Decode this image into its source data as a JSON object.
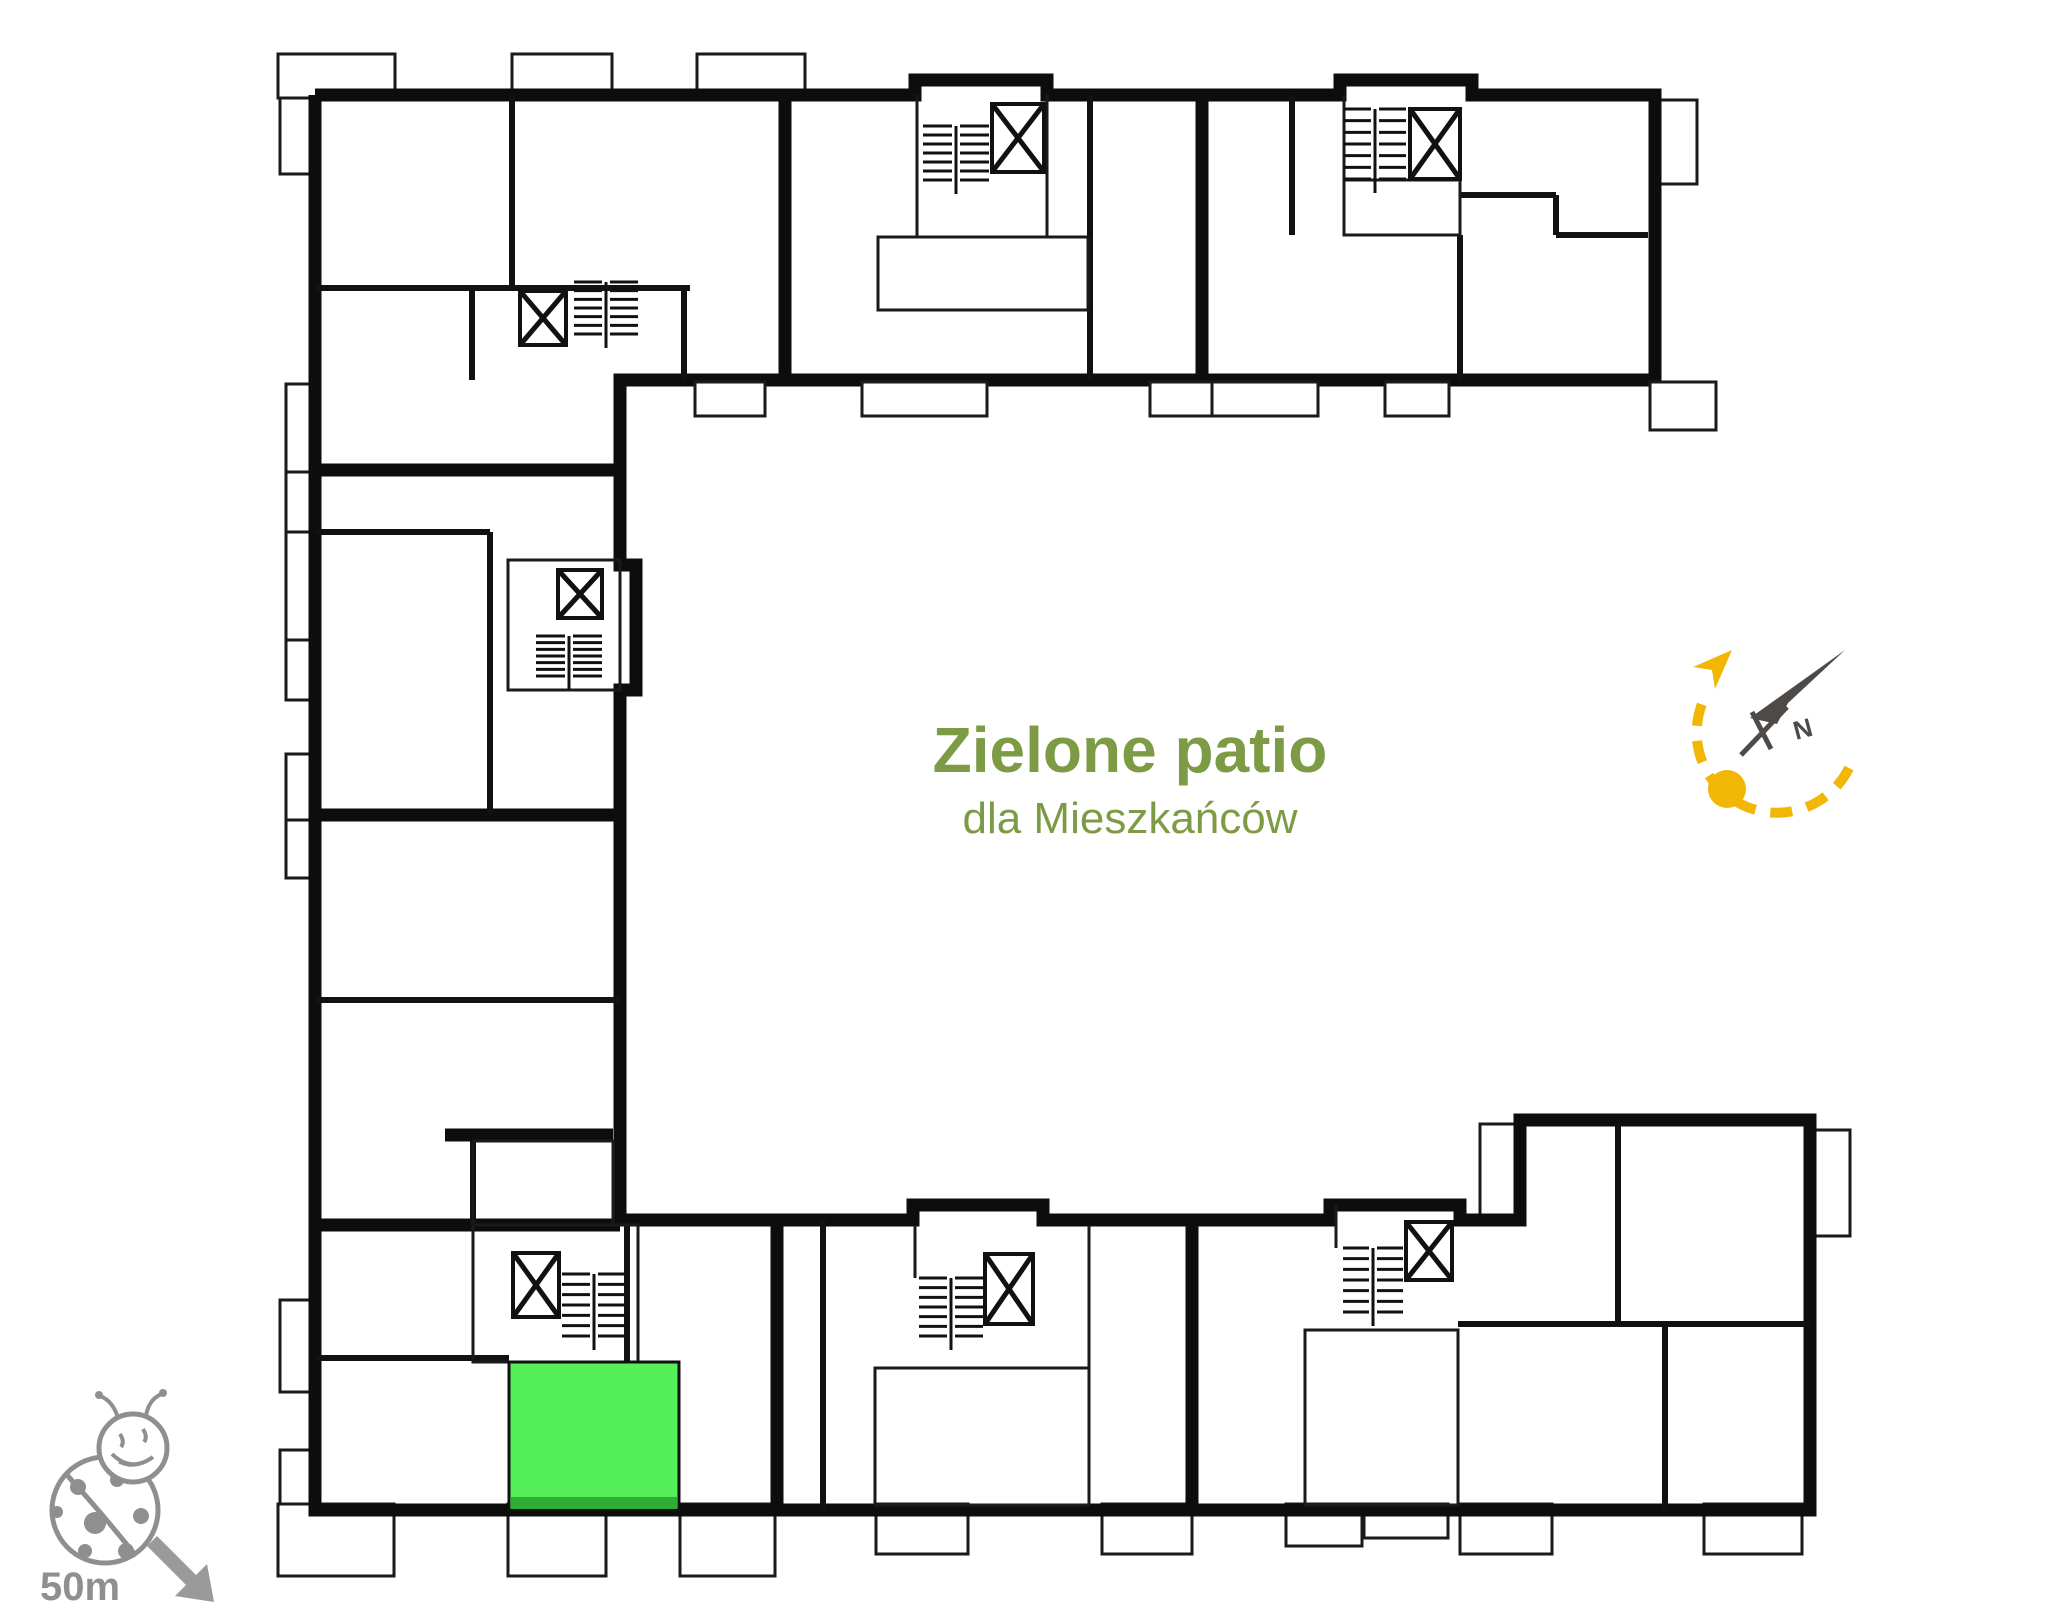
{
  "floor_plan": {
    "patio": {
      "title": "Zielone patio",
      "subtitle": "dla Mieszkańców",
      "title_color": "#7d9b45"
    },
    "highlighted_unit": {
      "color": "#55ef59",
      "edge_color": "#2fae35",
      "state": "highlighted"
    },
    "compass": {
      "north_label": "N",
      "needle_color": "#4e4a47",
      "sun_path_color": "#f2b705"
    },
    "scale_indicator": {
      "label": "50m",
      "color": "#8f8f8f"
    },
    "icons": {
      "ladybug_icon": "ladybug playground marker",
      "sun_path_icon": "dashed sun path arc with sun dot and arrow",
      "north_needle_icon": "north compass needle",
      "elevator_icon": "crossed square",
      "staircase_icon": "hatched treads"
    },
    "wall_color": "#0d0d0d"
  }
}
